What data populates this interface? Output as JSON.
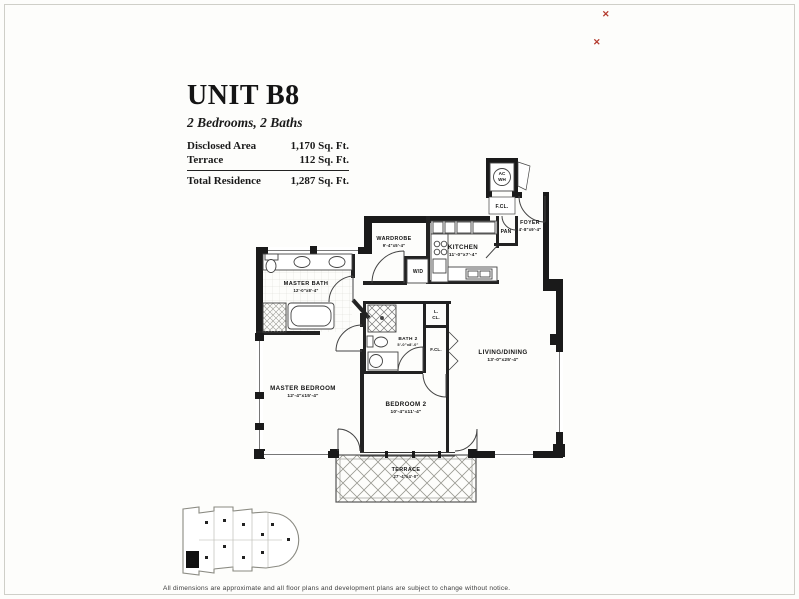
{
  "header": {
    "title": "UNIT B8",
    "subtitle": "2 Bedrooms, 2 Baths"
  },
  "stats": {
    "rows": [
      {
        "label": "Disclosed Area",
        "value": "1,170 Sq. Ft."
      },
      {
        "label": "Terrace",
        "value": "112 Sq. Ft."
      }
    ],
    "total": {
      "label": "Total Residence",
      "value": "1,287 Sq. Ft."
    }
  },
  "rooms": {
    "master_bath": {
      "name": "MASTER BATH",
      "dims": "12'-0\"x8'-4\""
    },
    "wardrobe": {
      "name": "WARDROBE",
      "dims": "9'-4\"x5'-4\""
    },
    "kitchen": {
      "name": "KITCHEN",
      "dims": "11'-0\"x7'-4\""
    },
    "foyer": {
      "name": "FOYER",
      "dims": "4'-8\"x9'-4\""
    },
    "master_bedroom": {
      "name": "MASTER BEDROOM",
      "dims": "12'-4\"x15'-4\""
    },
    "bedroom2": {
      "name": "BEDROOM 2",
      "dims": "10'-4\"x11'-4\""
    },
    "bath2": {
      "name": "BATH 2",
      "dims": "5'-0\"x8'-0\""
    },
    "living_dining": {
      "name": "LIVING/DINING",
      "dims": "13'-0\"x25'-4\""
    },
    "terrace": {
      "name": "TERRACE",
      "dims": "27'-4\"x4'-0\""
    }
  },
  "closets": {
    "fcl_upper": "F.CL.",
    "pan": "PAN",
    "wd": "W/D",
    "lcl_line1": "L.",
    "lcl_line2": "CL.",
    "fcl_lower": "F.CL.",
    "acwh_line1": "AC",
    "acwh_line2": "WH"
  },
  "keyplan": {
    "unit_marker": "B"
  },
  "artifacts": {
    "mark1": "✕",
    "mark2": "✕"
  },
  "footer": {
    "disclaimer": "All dimensions are approximate and all floor plans and development plans are subject to change without notice."
  },
  "colors": {
    "wall": "#1a1a1a",
    "accent_red": "#b43a2e",
    "scan_edge": "#cfcfc8"
  }
}
